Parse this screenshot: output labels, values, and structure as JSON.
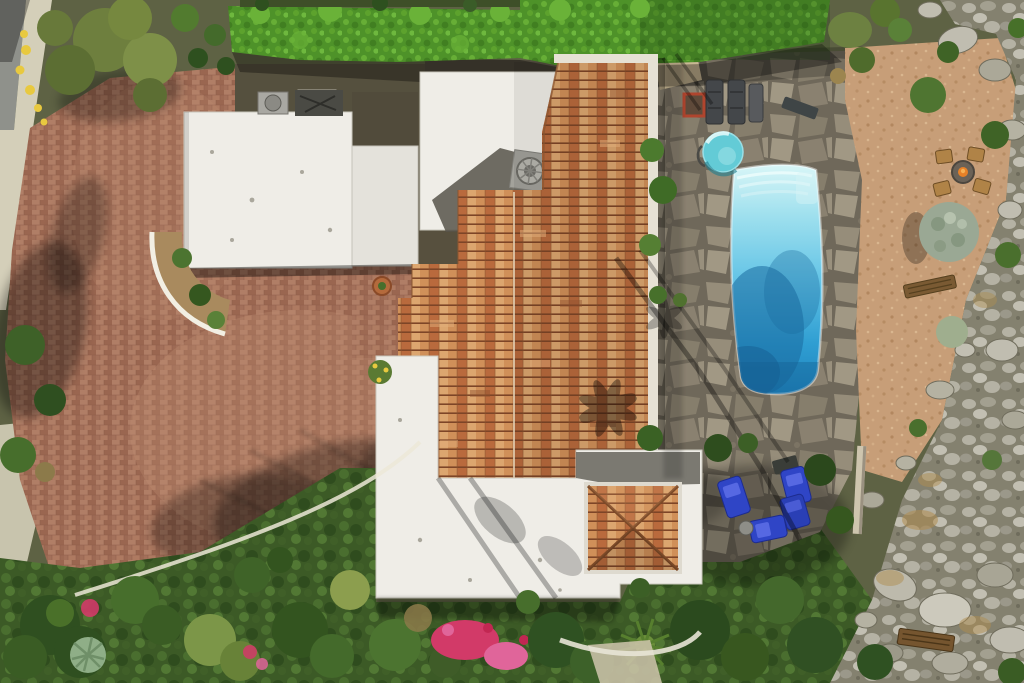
{
  "scene": {
    "title": "Aerial drone view of desert estate with swimming pool",
    "description": "Top-down aerial photograph: white flat roofs and terracotta tile roofs of a Spanish-style house, circular brick paver driveway, privacy hedge, flagstone pool patio with rectangular pool and round spa, blue chaise loungers, gravel fire-pit garden, rocky boulder hillside, and dense gardens with pink bougainvillea.",
    "elements": {
      "driveway": "brick paver circular driveway",
      "sidewalk": "concrete sidewalk and street edge",
      "hedge": "trimmed privacy hedge",
      "left_roof": "white flat roof - garage wing",
      "main_roof": "terracotta barrel-tile main roof",
      "lower_roof": "white flat roof with tiled hip pavilion",
      "chimney": "rooftop vent chimney",
      "pool": "rectangular swimming pool with steps",
      "spa": "round spa hot tub",
      "patio": "flagstone pool patio",
      "fire_pit": "gravel fire pit with four chairs",
      "blue_loungers": "blue chaise lounge group",
      "rock_hillside": "boulder-covered hillside",
      "bougainvillea": "pink bougainvillea shrubs",
      "palm_shadows": "palm tree shadows"
    }
  },
  "palette": {
    "road": "#8f918b",
    "sidewalk": "#d4cfb9",
    "curb": "#ece7d7",
    "brick_a": "#a3705a",
    "brick_b": "#b07e66",
    "brick_c": "#9a6650",
    "brick_line": "#8a5a47",
    "driveway_wash": "#c09074",
    "hedge": "#4e9229",
    "hedge_hi": "#6ab238",
    "hedge_lo": "#3d7a1f",
    "leaf_base": "#3c5a26",
    "tile_base": "#c07544",
    "tile_a": "#d09059",
    "tile_b": "#b96a3d",
    "tile_c": "#dca66f",
    "tile_gap": "#7d4527",
    "roof_white": "#efede7",
    "roof_white2": "#e4e2db",
    "parapet": "#e6e1d4",
    "chimney": "#a3a29b",
    "roof_shadow": "#57544a",
    "stone_base": "#6f685a",
    "stone_a": "#968d7a",
    "stone_b": "#867e6c",
    "stone_c": "#a19884",
    "gravel": "#c79e78",
    "rock_base": "#84816f",
    "rock_a": "#b5b2a4",
    "rock_b": "#c2bfb2",
    "dry_grass": "#b08d4f",
    "pool_steps": "#d8f6f7",
    "pool_light": "#9fe0ee",
    "pool_mid": "#64c4e6",
    "pool_deep": "#2f9ed2",
    "pool_deepest": "#1f83bd",
    "pool_shade": "#19699f",
    "spa": "#63cbd6",
    "lounger_blue": "#2f45c6",
    "lounger_blue_hi": "#5668e2",
    "furniture_dark": "#44474a",
    "wood": "#b08347",
    "bench_wood": "#75552f",
    "flame": "#e78128",
    "flower_pink": "#d23a68",
    "flower_pink_hi": "#e0659a",
    "yellow": "#e8c93f",
    "trunk": "#cec5ae",
    "tree_dark": "#2f4f20",
    "tree_mid": "#476e2c",
    "tree_light": "#6d9442",
    "olive": "#7c9648",
    "silver_green": "#9aa894"
  }
}
